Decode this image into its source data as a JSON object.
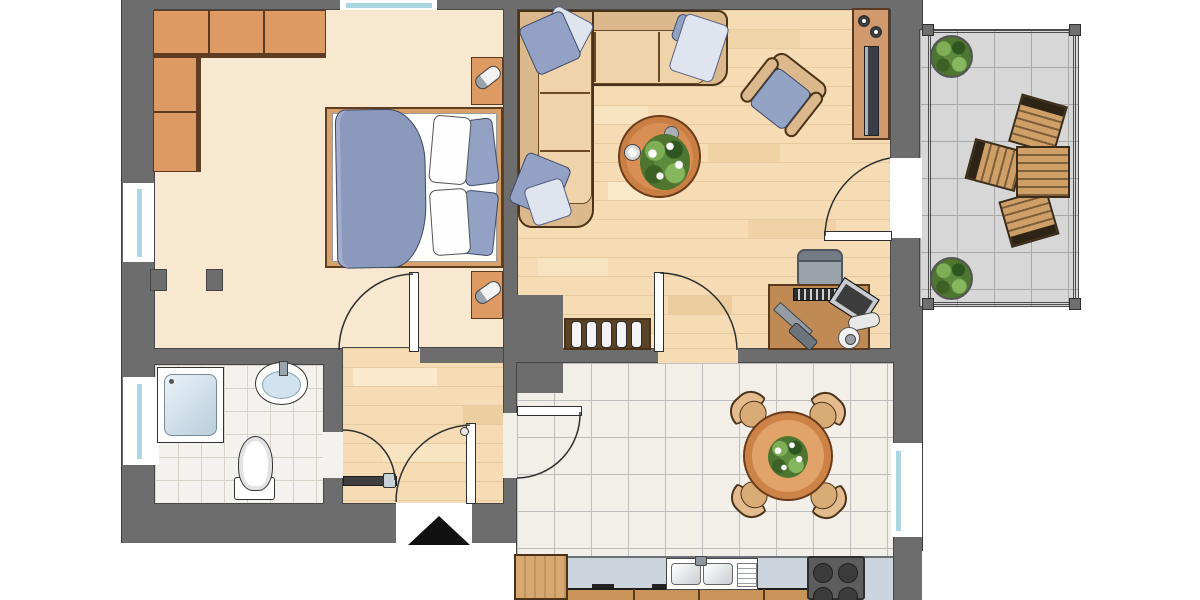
{
  "title": "Apartment floor plan with balcony",
  "palette": {
    "wall": "#6d6d6d",
    "bedroom_floor": "#f8e8cf",
    "parquet": "#f5dcb4",
    "bath_tile": "#f4f2ee",
    "kitchen_tile": "#f2efe9",
    "balcony_tile": "#d7d7d7",
    "furniture_wood": "#dd9a62",
    "sofa": "#ecd0a8",
    "textile_blue": "#93a2c4",
    "glass": "#a9d6e0",
    "counter": "#ccd5dd",
    "plant_green": "#4e7630"
  },
  "rooms": [
    {
      "name": "bedroom",
      "furniture": [
        "corner-wardrobe",
        "double-bed",
        "two-nightstands-with-lamps"
      ],
      "windows": [
        "left-wall",
        "top-wall"
      ]
    },
    {
      "name": "living-room",
      "furniture": [
        "corner-sofa",
        "coffee-table-with-plant",
        "armchair",
        "tv-sideboard",
        "desk-with-chair",
        "shelf-rack"
      ],
      "doors": [
        "balcony-door",
        "kitchen-door"
      ]
    },
    {
      "name": "hallway",
      "doors": [
        "bedroom-door",
        "bathroom-door",
        "front-door",
        "kitchen-door"
      ],
      "entrance_marker": "black-triangle"
    },
    {
      "name": "bathroom",
      "fixtures": [
        "shower",
        "washbasin",
        "toilet"
      ],
      "windows": [
        "left-wall"
      ]
    },
    {
      "name": "kitchen-dining",
      "furniture": [
        "round-dining-table-with-plant",
        "four-chairs",
        "kitchen-counter",
        "double-sink",
        "stove",
        "tall-cabinet"
      ],
      "windows": [
        "right-wall"
      ]
    },
    {
      "name": "balcony",
      "furniture": [
        "wooden-table",
        "three-wooden-chairs",
        "two-potted-plants"
      ],
      "floor": "concrete-tiles",
      "railing": "metal"
    }
  ],
  "doors_count": 6,
  "windows_count": 4
}
